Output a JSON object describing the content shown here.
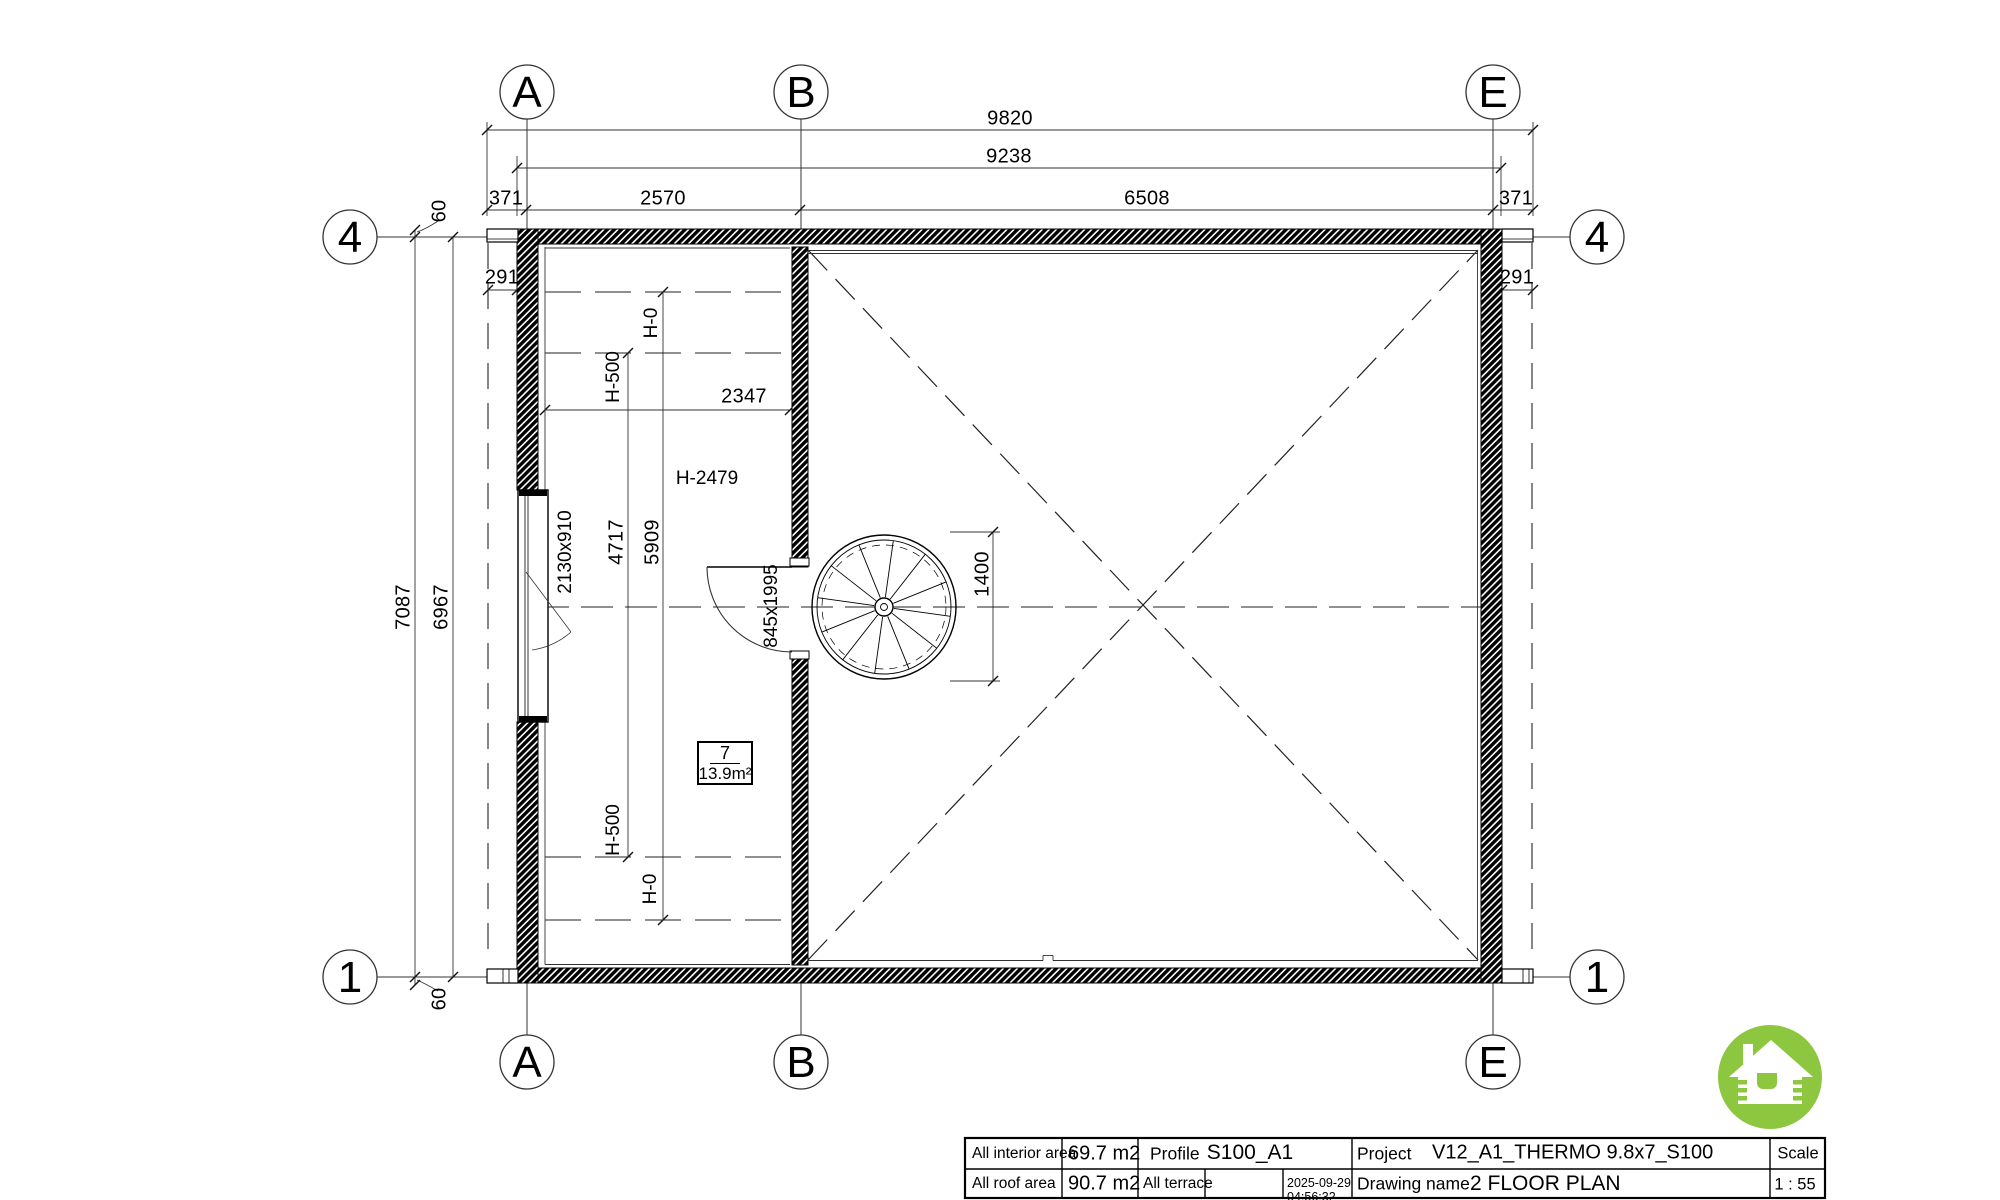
{
  "grid": {
    "a": "A",
    "b": "B",
    "e": "E",
    "four": "4",
    "one": "1"
  },
  "dims": {
    "d9820": "9820",
    "d9238": "9238",
    "d371": "371",
    "d2570": "2570",
    "d6508": "6508",
    "d7087": "7087",
    "d6967": "6967",
    "d60": "60",
    "d291": "291",
    "d2347": "2347",
    "d4717": "4717",
    "d5909": "5909",
    "d1400": "1400",
    "window_size": "2130x910",
    "door_size": "845x1995",
    "h0": "H-0",
    "h500": "H-500",
    "h2479": "H-2479"
  },
  "room": {
    "number": "7",
    "area": "13.9m²"
  },
  "title_block": {
    "interior_area_label": "All interior area",
    "interior_area_value": "69.7 m2",
    "roof_area_label": "All roof area",
    "roof_area_value": "90.7 m2",
    "profile_label": "Profile",
    "profile_value": "S100_A1",
    "terrace_label": "All terrace",
    "terrace_value": "",
    "date": "2025-09-29",
    "time": "04:56:32",
    "project_label": "Project",
    "project_value": "V12_A1_THERMO 9.8x7_S100",
    "drawing_name_label": "Drawing name",
    "drawing_name_value": "2 FLOOR PLAN",
    "scale_label": "Scale",
    "scale_value": "1 : 55"
  },
  "logo": {
    "color": "#8dc63f",
    "icon": "log-cabin-house"
  }
}
